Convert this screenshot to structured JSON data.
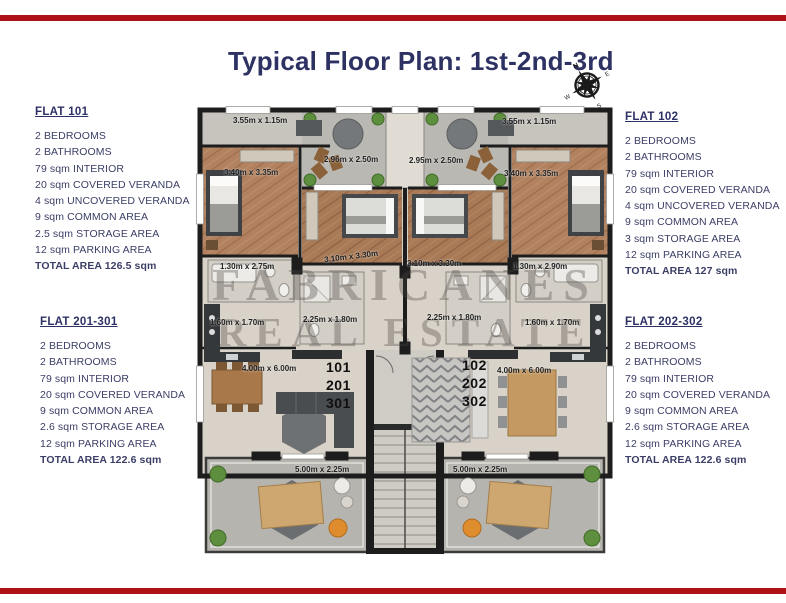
{
  "page": {
    "title": "Typical Floor Plan: 1st-2nd-3rd",
    "accent_color": "#ae1116",
    "title_color": "#2e3263"
  },
  "compass": {
    "north": "N",
    "east": "E",
    "south": "S",
    "west": "W"
  },
  "flats": {
    "flat101": {
      "title": "FLAT 101",
      "lines": [
        "2 BEDROOMS",
        "2 BATHROOMS",
        "79 sqm INTERIOR",
        "20 sqm COVERED VERANDA",
        "4 sqm UNCOVERED VERANDA",
        "9 sqm COMMON AREA",
        "2.5 sqm STORAGE AREA",
        "12 sqm PARKING AREA"
      ],
      "total": "TOTAL AREA 126.5 sqm"
    },
    "flat102": {
      "title": "FLAT 102",
      "lines": [
        "2 BEDROOMS",
        "2 BATHROOMS",
        "79 sqm INTERIOR",
        "20 sqm COVERED VERANDA",
        "4 sqm UNCOVERED VERANDA",
        "9 sqm COMMON AREA",
        "3 sqm STORAGE AREA",
        "12 sqm PARKING AREA"
      ],
      "total": "TOTAL AREA 127 sqm"
    },
    "flat201_301": {
      "title": "FLAT 201-301",
      "lines": [
        "2 BEDROOMS",
        "2 BATHROOMS",
        "79 sqm INTERIOR",
        "20 sqm COVERED VERANDA",
        "9 sqm COMMON AREA",
        "2.6 sqm STORAGE AREA",
        "12 sqm PARKING AREA"
      ],
      "total": "TOTAL AREA 122.6 sqm"
    },
    "flat202_302": {
      "title": "FLAT 202-302",
      "lines": [
        "2 BEDROOMS",
        "2 BATHROOMS",
        "79 sqm INTERIOR",
        "20 sqm COVERED VERANDA",
        "9 sqm COMMON AREA",
        "2.6 sqm STORAGE AREA",
        "12 sqm PARKING AREA"
      ],
      "total": "TOTAL AREA 122.6 sqm"
    }
  },
  "plan": {
    "watermark": {
      "line1": "FABRICANES",
      "line2": "REAL ESTATE"
    },
    "unit_stack_left": [
      "101",
      "201",
      "301"
    ],
    "unit_stack_right": [
      "102",
      "202",
      "302"
    ],
    "dims": {
      "balcony_tl": "3.55m x 1.15m",
      "terrace_l": "2.96m x 2.50m",
      "bedroom1_l": "3.40m x 3.35m",
      "bedroom2_l": "3.10m x 3.30m",
      "bath_l": "1.30m x 2.75m",
      "wc_l": "1.60m x 1.70m",
      "bath2_l": "2.25m x 1.80m",
      "living_l": "4.00m x 6.00m",
      "veranda_l": "5.00m x 2.25m",
      "balcony_tr": "3.55m x 1.15m",
      "terrace_r": "2.95m x 2.50m",
      "bedroom1_r": "3.40m x 3.35m",
      "bedroom2_r": "3.10m x 3.30m",
      "bath_r": "1.30m x 2.90m",
      "wc_r": "1.60m x 1.70m",
      "bath2_r": "2.25m x 1.80m",
      "living_r": "4.00m x 6.00m",
      "veranda_r": "5.00m x 2.25m"
    }
  }
}
